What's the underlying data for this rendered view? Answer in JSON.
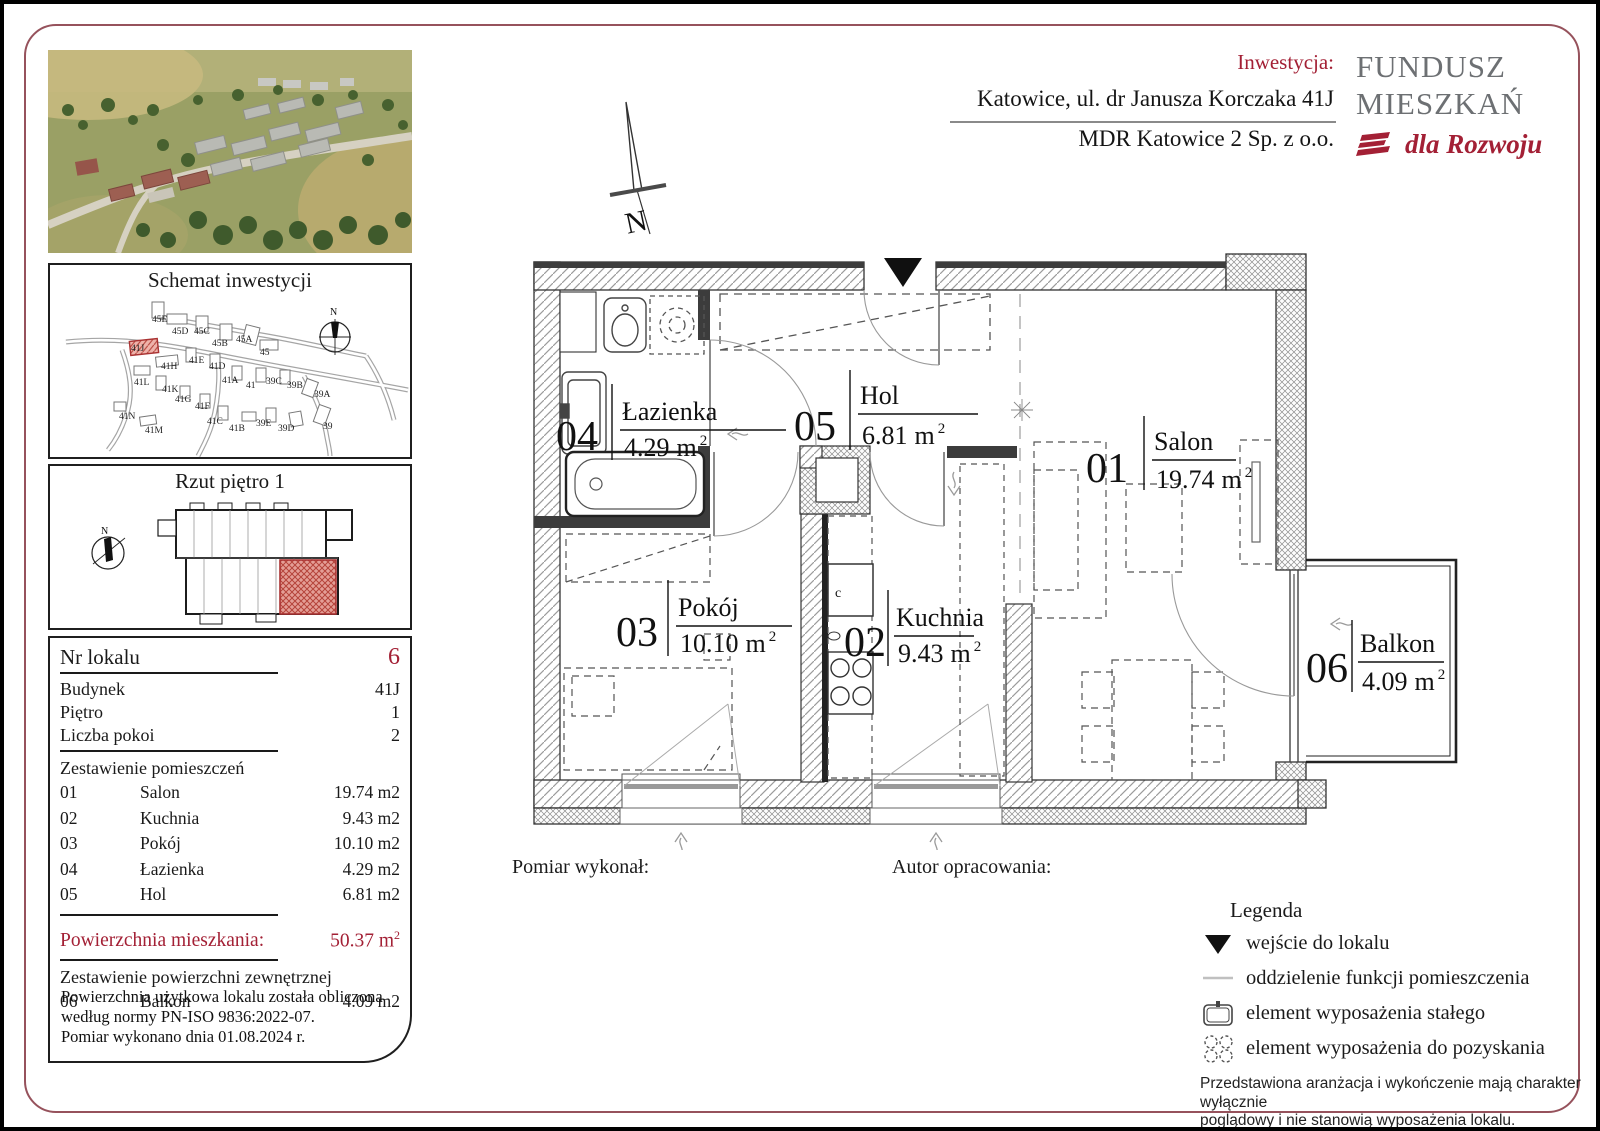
{
  "colors": {
    "accent_red": "#a32035",
    "frame_maroon": "#96525c",
    "logo_gray": "#6d7073",
    "highlight_fill": "#eeb3ab",
    "highlight_stroke": "#b5433a"
  },
  "header": {
    "investment_label": "Inwestycja:",
    "address": "Katowice, ul. dr Janusza Korczaka 41J",
    "developer": "MDR Katowice 2 Sp. z o.o.",
    "logo_line1": "FUNDUSZ",
    "logo_line2": "MIESZKAŃ",
    "logo_line3": "dla Rozwoju",
    "logo_icon": "three-red-stripes"
  },
  "site": {
    "title": "Schemat inwestycji",
    "north": "N",
    "highlighted_building": "41J",
    "labels": [
      "45E",
      "45D",
      "45C",
      "45B",
      "45A",
      "45",
      "41J",
      "41H",
      "41E",
      "41D",
      "41A",
      "41",
      "39C",
      "39B",
      "39A",
      "41L",
      "41K",
      "41G",
      "41F",
      "41C",
      "41B",
      "39E",
      "39D",
      "39",
      "41N",
      "41M"
    ]
  },
  "floor_view": {
    "title": "Rzut piętro 1",
    "north": "N"
  },
  "unit": {
    "fields": [
      {
        "label": "Nr lokalu",
        "value": "6"
      },
      {
        "label": "Budynek",
        "value": "41J"
      },
      {
        "label": "Piętro",
        "value": "1"
      },
      {
        "label": "Liczba pokoi",
        "value": "2"
      }
    ],
    "rooms_header": "Zestawienie pomieszczeń",
    "rooms": [
      {
        "code": "01",
        "name": "Salon",
        "area": "19.74 m2"
      },
      {
        "code": "02",
        "name": "Kuchnia",
        "area": "9.43 m2"
      },
      {
        "code": "03",
        "name": "Pokój",
        "area": "10.10 m2"
      },
      {
        "code": "04",
        "name": "Łazienka",
        "area": "4.29 m2"
      },
      {
        "code": "05",
        "name": "Hol",
        "area": "6.81 m2"
      }
    ],
    "total_label": "Powierzchnia mieszkania:",
    "total_value": "50.37",
    "total_unit": "m",
    "total_sup": "2",
    "external_header": "Zestawienie powierzchni zewnętrznej",
    "external": [
      {
        "code": "06",
        "name": "Balkon",
        "area": "4.09 m2"
      }
    ],
    "note_lines": [
      "Powierzchnia użytkowa lokalu została obliczona",
      "według normy PN-ISO 9836:2022-07.",
      "Pomiar wykonano dnia 01.08.2024 r."
    ]
  },
  "plan": {
    "north": "N",
    "unit": "m",
    "sup": "2",
    "fridge_label": "c",
    "rooms": [
      {
        "code": "01",
        "name": "Salon",
        "area": "19.74"
      },
      {
        "code": "02",
        "name": "Kuchnia",
        "area": "9.43"
      },
      {
        "code": "03",
        "name": "Pokój",
        "area": "10.10"
      },
      {
        "code": "04",
        "name": "Łazienka",
        "area": "4.29"
      },
      {
        "code": "05",
        "name": "Hol",
        "area": "6.81"
      },
      {
        "code": "06",
        "name": "Balkon",
        "area": "4.09"
      }
    ]
  },
  "footer": {
    "surveyor_label": "Pomiar wykonał:",
    "author_label": "Autor opracowania:"
  },
  "legend": {
    "title": "Legenda",
    "items": [
      {
        "icon": "entrance-triangle",
        "label": "wejście do lokalu"
      },
      {
        "icon": "separation-line",
        "label": "oddzielenie funkcji pomieszczenia"
      },
      {
        "icon": "fixed-equipment",
        "label": "element wyposażenia stałego"
      },
      {
        "icon": "acquirable-equipment",
        "label": "element wyposażenia do pozyskania"
      }
    ],
    "disclaimer_lines": [
      "Przedstawiona aranżacja i wykończenie mają charakter wyłącznie",
      "poglądowy i nie stanowią wyposażenia lokalu."
    ]
  }
}
